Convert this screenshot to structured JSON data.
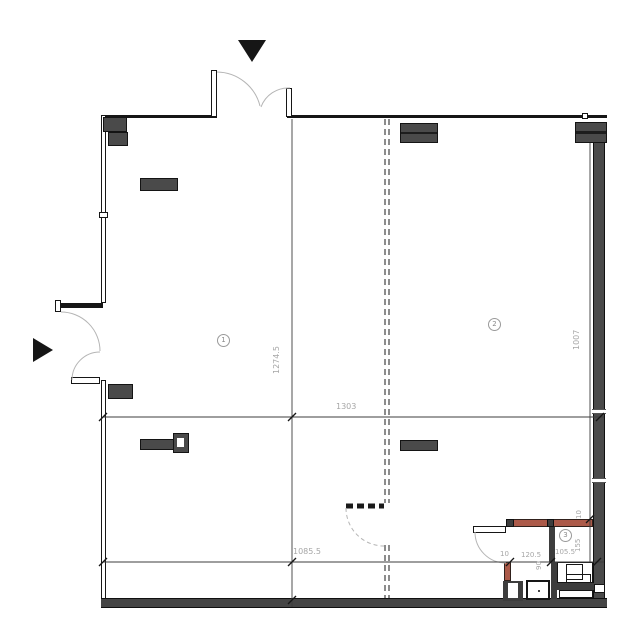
{
  "rooms": [
    {
      "number": "1"
    },
    {
      "number": "2"
    },
    {
      "number": "3"
    }
  ],
  "dimensions": {
    "h_mid": "1303",
    "v_left": "1274.5",
    "h_lower": "1085.5",
    "v_right": "1007",
    "bath_gap": "10",
    "bath_w1": "120.5",
    "bath_w2": "105.5",
    "bath_depth": "90",
    "right_gap": "10",
    "right_w": "155"
  },
  "colors": {
    "wall_dark": "#4a4a4a",
    "wall_line": "#161616",
    "accent_red": "#ac5a49",
    "dim_text": "#a6a6a6"
  },
  "icons": {
    "entrance_top": "filled-triangle-down",
    "entrance_left": "filled-triangle-right"
  }
}
